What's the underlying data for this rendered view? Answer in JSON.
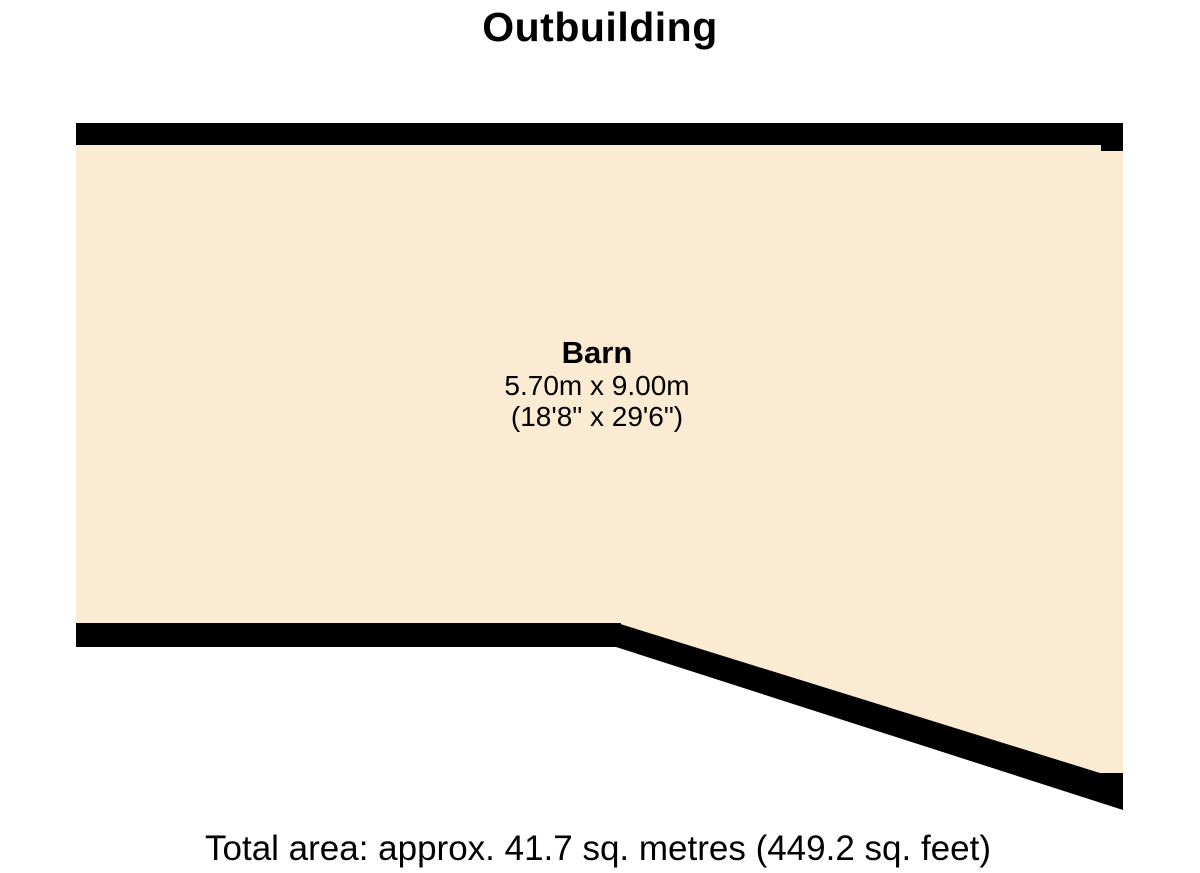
{
  "title": "Outbuilding",
  "room": {
    "name": "Barn",
    "dimensions_metric": "5.70m x 9.00m",
    "dimensions_imperial": "(18'8\" x 29'6\")"
  },
  "footer": {
    "total_area_label": "Total area: approx. 41.7 sq. metres (449.2 sq. feet)"
  },
  "colors": {
    "background": "#FFFFFF",
    "floor_fill": "#FAEBD2",
    "wall": "#000000",
    "text": "#000000"
  }
}
